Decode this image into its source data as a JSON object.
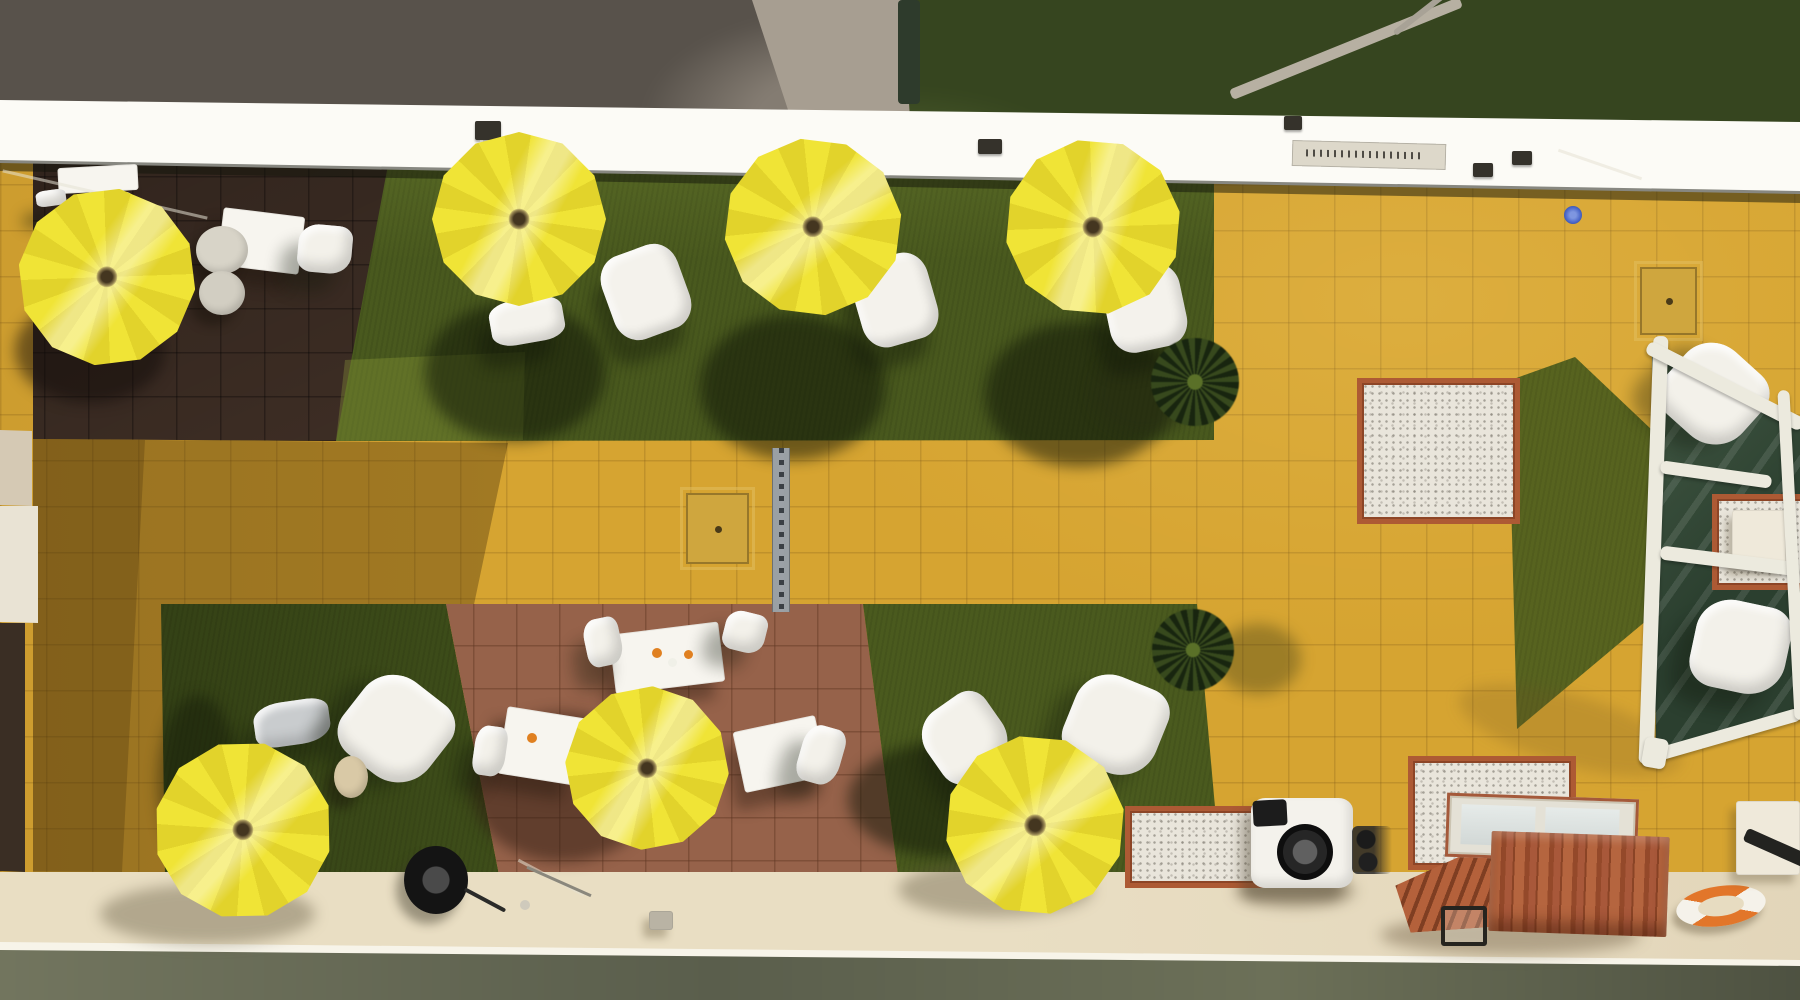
{
  "scene": {
    "description": "Aerial drone photo of a hotel roof terrace with yellow parasols, white furniture, artificial grass patches, mustard tiled plaza, brown tiled seating areas, a glass pergola, brick barbecue and heat pump",
    "width": 1800,
    "height": 1000,
    "visible_text": ""
  },
  "palette": {
    "parasol_yellow": "#efe335",
    "tile_yellow": "#d6a431",
    "grass_green": "#49591e",
    "tile_brown_dark": "#4a372c",
    "tile_brown_red": "#96624a",
    "wall_cream": "#f0ead9",
    "walkway_cream": "#e9dec3",
    "brick_orange": "#ad5a34",
    "gravel_white": "#e9e5db",
    "lifebuoy_orange": "#e2762a",
    "pool_light_blue": "#4a66c8"
  },
  "items": [
    {
      "n": "shadow-umbrella-2",
      "t": "shadow",
      "x": 425,
      "y": 302,
      "w": 180,
      "h": 140,
      "c": "rgba(14,20,6,.52)"
    },
    {
      "n": "shadow-umbrella-3",
      "t": "shadow",
      "x": 700,
      "y": 315,
      "w": 185,
      "h": 145,
      "c": "rgba(14,20,6,.52)"
    },
    {
      "n": "shadow-umbrella-4",
      "t": "shadow",
      "x": 985,
      "y": 322,
      "w": 190,
      "h": 145,
      "c": "rgba(14,20,6,.52)"
    },
    {
      "n": "shadow-umbrella-1",
      "t": "shadow",
      "x": 15,
      "y": 298,
      "w": 150,
      "h": 105,
      "c": "rgba(15,10,7,.5)"
    },
    {
      "n": "shadow-umbrella-6",
      "t": "shadow",
      "x": 470,
      "y": 712,
      "w": 185,
      "h": 150,
      "c": "rgba(44,26,15,.5)"
    },
    {
      "n": "shadow-umbrella-7-grass",
      "t": "shadow",
      "x": 848,
      "y": 742,
      "w": 195,
      "h": 115,
      "c": "rgba(14,20,6,.5)"
    },
    {
      "n": "shadow-umbrella-7-walk",
      "t": "shadow",
      "x": 898,
      "y": 862,
      "w": 195,
      "h": 55,
      "c": "rgba(95,85,60,.4)"
    },
    {
      "n": "shadow-umbrella-5-walk",
      "t": "shadow",
      "x": 100,
      "y": 884,
      "w": 215,
      "h": 60,
      "c": "rgba(95,85,60,.4)"
    },
    {
      "n": "shadow-umbrella-5-grass",
      "t": "shadow",
      "x": 158,
      "y": 695,
      "w": 80,
      "h": 175,
      "c": "rgba(12,18,6,.4)"
    },
    {
      "n": "shadow-palm-1",
      "t": "shadow",
      "x": 1092,
      "y": 350,
      "w": 105,
      "h": 85,
      "c": "rgba(40,45,18,.38)"
    },
    {
      "n": "shadow-palm-2",
      "t": "shadow",
      "x": 1216,
      "y": 624,
      "w": 85,
      "h": 70,
      "c": "rgba(40,45,18,.33)"
    },
    {
      "n": "shadow-pergola",
      "t": "shadow",
      "x": 1455,
      "y": 695,
      "w": 230,
      "h": 70,
      "r": 16,
      "c": "rgba(110,80,30,.22)"
    },
    {
      "n": "shadow-bbq",
      "t": "shadow",
      "x": 1380,
      "y": 915,
      "w": 260,
      "h": 40,
      "c": "rgba(80,60,35,.35)"
    },
    {
      "n": "shadow-heatpump",
      "t": "shadow",
      "x": 1235,
      "y": 875,
      "w": 120,
      "h": 32,
      "c": "rgba(85,70,45,.4)"
    },
    {
      "n": "branch",
      "t": "bar",
      "x": 1222,
      "y": 43,
      "w": 248,
      "h": 11,
      "r": -22,
      "c": "#b7b0a2",
      "z": 2
    },
    {
      "n": "twig",
      "t": "bar",
      "x": 1386,
      "y": 6,
      "w": 80,
      "h": 6,
      "r": -38,
      "c": "#a8a296",
      "z": 2
    },
    {
      "n": "fence-post",
      "t": "bar",
      "x": 898,
      "y": 0,
      "w": 22,
      "h": 104,
      "c": "#2e3b2c",
      "z": 2
    },
    {
      "n": "edge-sign",
      "t": "sign",
      "x": 1292,
      "y": 142,
      "w": 154,
      "h": 26,
      "r": 1.5
    },
    {
      "n": "edge-vent",
      "t": "clamp",
      "x": 978,
      "y": 139,
      "w": 24,
      "h": 15
    },
    {
      "n": "edge-clamp-1",
      "t": "clamp",
      "x": 1473,
      "y": 163,
      "w": 20,
      "h": 14
    },
    {
      "n": "edge-clamp-2",
      "t": "clamp",
      "x": 1512,
      "y": 151,
      "w": 20,
      "h": 14
    },
    {
      "n": "edge-clamp-3",
      "t": "clamp",
      "x": 475,
      "y": 121,
      "w": 26,
      "h": 19
    },
    {
      "n": "edge-clamp-4",
      "t": "clamp",
      "x": 1284,
      "y": 116,
      "w": 18,
      "h": 14
    },
    {
      "n": "wire-1",
      "t": "wire",
      "x": 0,
      "y": 193,
      "w": 210,
      "h": 3,
      "r": 13
    },
    {
      "n": "wire-2",
      "t": "wire",
      "x": 1556,
      "y": 163,
      "w": 88,
      "h": 3,
      "r": 19
    },
    {
      "n": "wire-pole",
      "t": "wire",
      "x": 480,
      "y": 140,
      "w": 3,
      "h": 58
    },
    {
      "n": "table-topleft",
      "t": "table",
      "x": 58,
      "y": 166,
      "w": 80,
      "h": 26,
      "r": -3
    },
    {
      "n": "seat-topleft-1",
      "t": "pouf",
      "x": 36,
      "y": 190,
      "w": 30,
      "h": 16,
      "r": -8
    },
    {
      "n": "seat-topleft-2",
      "t": "pouf",
      "x": 98,
      "y": 192,
      "w": 34,
      "h": 16,
      "r": -4
    },
    {
      "n": "table-topleft-2",
      "t": "table",
      "x": 220,
      "y": 212,
      "w": 82,
      "h": 58,
      "r": 7
    },
    {
      "n": "chair-topleft",
      "t": "chair",
      "x": 298,
      "y": 225,
      "w": 54,
      "h": 48,
      "r": 5
    },
    {
      "n": "round-table-1",
      "t": "disc",
      "x": 196,
      "y": 226,
      "w": 52,
      "h": 48,
      "c": "#d8d4c8"
    },
    {
      "n": "round-table-2",
      "t": "disc",
      "x": 199,
      "y": 271,
      "w": 46,
      "h": 44,
      "c": "#d2cec2"
    },
    {
      "n": "pouf-grass-1",
      "t": "pouf",
      "x": 490,
      "y": 299,
      "w": 74,
      "h": 44,
      "r": -10
    },
    {
      "n": "pouf-grass-2",
      "t": "pouf",
      "x": 606,
      "y": 248,
      "w": 80,
      "h": 88,
      "r": -20
    },
    {
      "n": "pouf-grass-3",
      "t": "pouf",
      "x": 856,
      "y": 256,
      "w": 78,
      "h": 88,
      "r": -16
    },
    {
      "n": "pouf-grass-4",
      "t": "pouf",
      "x": 1106,
      "y": 266,
      "w": 78,
      "h": 84,
      "r": -12
    },
    {
      "n": "chair-gray-bl",
      "t": "chair",
      "x": 254,
      "y": 701,
      "w": 76,
      "h": 44,
      "r": -8,
      "c": "#c9ccce"
    },
    {
      "n": "chair-white-bl",
      "t": "chair",
      "x": 346,
      "y": 680,
      "w": 100,
      "h": 98,
      "r": 38
    },
    {
      "n": "side-table-beige",
      "t": "disc",
      "x": 334,
      "y": 756,
      "w": 34,
      "h": 42,
      "c": "#d9c9a6"
    },
    {
      "n": "cable-reel",
      "t": "reel",
      "x": 404,
      "y": 846,
      "w": 64,
      "h": 68
    },
    {
      "n": "cable-cord",
      "t": "bar",
      "x": 462,
      "y": 898,
      "w": 46,
      "h": 4,
      "r": 28,
      "c": "#2a2a28"
    },
    {
      "n": "table-brown-1",
      "t": "table",
      "x": 612,
      "y": 628,
      "w": 110,
      "h": 60,
      "r": -7
    },
    {
      "n": "table-brown-2",
      "t": "table",
      "x": 502,
      "y": 712,
      "w": 80,
      "h": 68,
      "r": 9
    },
    {
      "n": "table-brown-3",
      "t": "table",
      "x": 738,
      "y": 723,
      "w": 84,
      "h": 62,
      "r": -12
    },
    {
      "n": "chair-brown-1",
      "t": "chair",
      "x": 585,
      "y": 618,
      "w": 36,
      "h": 48,
      "r": -12
    },
    {
      "n": "chair-brown-2",
      "t": "chair",
      "x": 724,
      "y": 612,
      "w": 42,
      "h": 40,
      "r": 14
    },
    {
      "n": "chair-brown-3",
      "t": "chair",
      "x": 474,
      "y": 726,
      "w": 32,
      "h": 50,
      "r": 8
    },
    {
      "n": "chair-brown-4",
      "t": "chair",
      "x": 800,
      "y": 726,
      "w": 42,
      "h": 58,
      "r": 16
    },
    {
      "n": "chair-brown-5",
      "t": "chair",
      "x": 640,
      "y": 700,
      "w": 44,
      "h": 62,
      "r": -24
    },
    {
      "n": "table-item-1",
      "t": "dot",
      "x": 652,
      "y": 648,
      "w": 10,
      "h": 10,
      "c": "#e08020"
    },
    {
      "n": "table-item-2",
      "t": "dot",
      "x": 668,
      "y": 658,
      "w": 9,
      "h": 9,
      "c": "#f0f0e8"
    },
    {
      "n": "table-item-3",
      "t": "dot",
      "x": 684,
      "y": 650,
      "w": 9,
      "h": 9,
      "c": "#e08020"
    },
    {
      "n": "table-item-4",
      "t": "dot",
      "x": 527,
      "y": 733,
      "w": 10,
      "h": 10,
      "c": "#e08020"
    },
    {
      "n": "chair-green3-a",
      "t": "chair",
      "x": 926,
      "y": 698,
      "w": 78,
      "h": 80,
      "r": -35
    },
    {
      "n": "chair-green3-b",
      "t": "chair",
      "x": 1068,
      "y": 678,
      "w": 95,
      "h": 94,
      "r": 22
    },
    {
      "n": "palm-1",
      "t": "palm",
      "x": 1151,
      "y": 338,
      "w": 88,
      "h": 88
    },
    {
      "n": "palm-2",
      "t": "palm",
      "x": 1152,
      "y": 609,
      "w": 82,
      "h": 82
    },
    {
      "n": "gravel-square-main",
      "t": "gravel",
      "x": 1357,
      "y": 378,
      "w": 153,
      "h": 136
    },
    {
      "n": "gravel-strip-left",
      "t": "gravel",
      "x": 1125,
      "y": 806,
      "w": 128,
      "h": 72
    },
    {
      "n": "gravel-bbq-back",
      "t": "gravel",
      "x": 1408,
      "y": 756,
      "w": 158,
      "h": 104
    },
    {
      "n": "roof-hatch-topright",
      "t": "hatch",
      "x": 1640,
      "y": 267,
      "w": 53,
      "h": 64
    },
    {
      "n": "roof-hatch-walkway",
      "t": "hatch",
      "x": 686,
      "y": 493,
      "w": 59,
      "h": 67
    },
    {
      "n": "drain-channel",
      "t": "drain",
      "x": 772,
      "y": 448,
      "w": 16,
      "h": 164
    },
    {
      "n": "pool-light-blue",
      "t": "dot",
      "x": 1564,
      "y": 206,
      "w": 18,
      "h": 18,
      "c": "radial-gradient(circle,#7e96e0 0 25%,#4a66c8 60%,#243a7a)"
    },
    {
      "n": "heat-pump",
      "t": "pump",
      "x": 1251,
      "y": 798,
      "w": 102,
      "h": 90
    },
    {
      "n": "heat-pump-fan",
      "t": "fan",
      "x": 1277,
      "y": 824,
      "w": 56,
      "h": 56
    },
    {
      "n": "heat-pump-top",
      "t": "bar",
      "x": 1253,
      "y": 800,
      "w": 34,
      "h": 26,
      "r": -3,
      "c": "#1c1c1c"
    },
    {
      "n": "heat-pump-pipes",
      "t": "pipes",
      "x": 1352,
      "y": 826,
      "w": 40,
      "h": 48
    },
    {
      "n": "bbq-steps",
      "t": "steps",
      "x": 1396,
      "y": 856,
      "w": 104,
      "h": 74,
      "r": -4
    },
    {
      "n": "bbq-top",
      "t": "bbqtop",
      "x": 1446,
      "y": 796,
      "w": 186,
      "h": 58,
      "r": 2
    },
    {
      "n": "bbq-body",
      "t": "bbqbody",
      "x": 1490,
      "y": 834,
      "w": 178,
      "h": 100,
      "r": 2
    },
    {
      "n": "bbq-handle",
      "t": "bracket",
      "x": 1441,
      "y": 906,
      "w": 38,
      "h": 32
    },
    {
      "n": "lifebuoy",
      "t": "ring",
      "x": 1676,
      "y": 886,
      "w": 90,
      "h": 40,
      "r": -8
    },
    {
      "n": "door-panel",
      "t": "panel",
      "x": 1736,
      "y": 801,
      "w": 64,
      "h": 74
    },
    {
      "n": "black-pipe",
      "t": "bar",
      "x": 1742,
      "y": 843,
      "w": 78,
      "h": 14,
      "r": 24,
      "z": 13
    },
    {
      "n": "walkway-hatch-small",
      "t": "panel",
      "x": 649,
      "y": 911,
      "w": 24,
      "h": 19,
      "c": "#b9b3a4"
    },
    {
      "n": "walkway-rod-1",
      "t": "wire",
      "x": 514,
      "y": 876,
      "w": 74,
      "h": 3,
      "r": 28
    },
    {
      "n": "walkway-rod-2",
      "t": "wire",
      "x": 524,
      "y": 880,
      "w": 70,
      "h": 3,
      "r": 24,
      "c": "#8a877c"
    },
    {
      "n": "walkway-ring-small",
      "t": "dot",
      "x": 520,
      "y": 900,
      "w": 10,
      "h": 10,
      "c": "#cfcabc"
    },
    {
      "n": "pergola-glass",
      "t": "glass",
      "x": 1652,
      "y": 352,
      "w": 148,
      "h": 410,
      "clip": "polygon(0px 0px,148px 76px,148px 364px,4px 410px)"
    },
    {
      "n": "pergola-chair-1",
      "t": "chair",
      "x": 1666,
      "y": 348,
      "w": 95,
      "h": 92,
      "r": 42,
      "z": 12
    },
    {
      "n": "pergola-chair-2",
      "t": "chair",
      "x": 1693,
      "y": 602,
      "w": 95,
      "h": 90,
      "r": 12,
      "z": 12
    },
    {
      "n": "pergola-gravel",
      "t": "gravel",
      "x": 1712,
      "y": 494,
      "w": 88,
      "h": 86,
      "z": 12
    },
    {
      "n": "pergola-table-white",
      "t": "panel",
      "x": 1732,
      "y": 510,
      "w": 54,
      "h": 58,
      "z": 12
    },
    {
      "n": "pergola-bar-left",
      "t": "frame",
      "x": 1646,
      "y": 336,
      "w": 15,
      "h": 428,
      "r": 2
    },
    {
      "n": "pergola-bar-top",
      "t": "frame",
      "x": 1638,
      "y": 379,
      "w": 174,
      "h": 14,
      "r": 27
    },
    {
      "n": "pergola-bar-mid1",
      "t": "frame",
      "x": 1660,
      "y": 468,
      "w": 112,
      "h": 13,
      "r": 8
    },
    {
      "n": "pergola-bar-mid2",
      "t": "frame",
      "x": 1660,
      "y": 554,
      "w": 140,
      "h": 14,
      "r": 7
    },
    {
      "n": "pergola-bar-bottom",
      "t": "frame",
      "x": 1646,
      "y": 729,
      "w": 157,
      "h": 13,
      "r": -16
    },
    {
      "n": "pergola-bar-right",
      "t": "frame",
      "x": 1786,
      "y": 390,
      "w": 12,
      "h": 330,
      "r": -3
    },
    {
      "n": "pergola-foot",
      "t": "frame",
      "x": 1643,
      "y": 738,
      "w": 24,
      "h": 30,
      "r": 10
    },
    {
      "n": "umbrella-1",
      "t": "umbrella",
      "x": 18,
      "y": 188,
      "w": 178,
      "h": 178,
      "r": 8
    },
    {
      "n": "umbrella-2",
      "t": "umbrella",
      "x": 432,
      "y": 132,
      "w": 174,
      "h": 174
    },
    {
      "n": "umbrella-3",
      "t": "umbrella",
      "x": 724,
      "y": 138,
      "w": 178,
      "h": 178,
      "r": 22
    },
    {
      "n": "umbrella-4",
      "t": "umbrella",
      "x": 1005,
      "y": 139,
      "w": 176,
      "h": 176,
      "r": -10
    },
    {
      "n": "umbrella-5",
      "t": "umbrella",
      "x": 154,
      "y": 741,
      "w": 178,
      "h": 178,
      "r": 14
    },
    {
      "n": "umbrella-6",
      "t": "umbrella",
      "x": 565,
      "y": 686,
      "w": 164,
      "h": 164,
      "r": 4
    },
    {
      "n": "umbrella-7",
      "t": "umbrella",
      "x": 945,
      "y": 735,
      "w": 180,
      "h": 180,
      "r": 20
    }
  ]
}
